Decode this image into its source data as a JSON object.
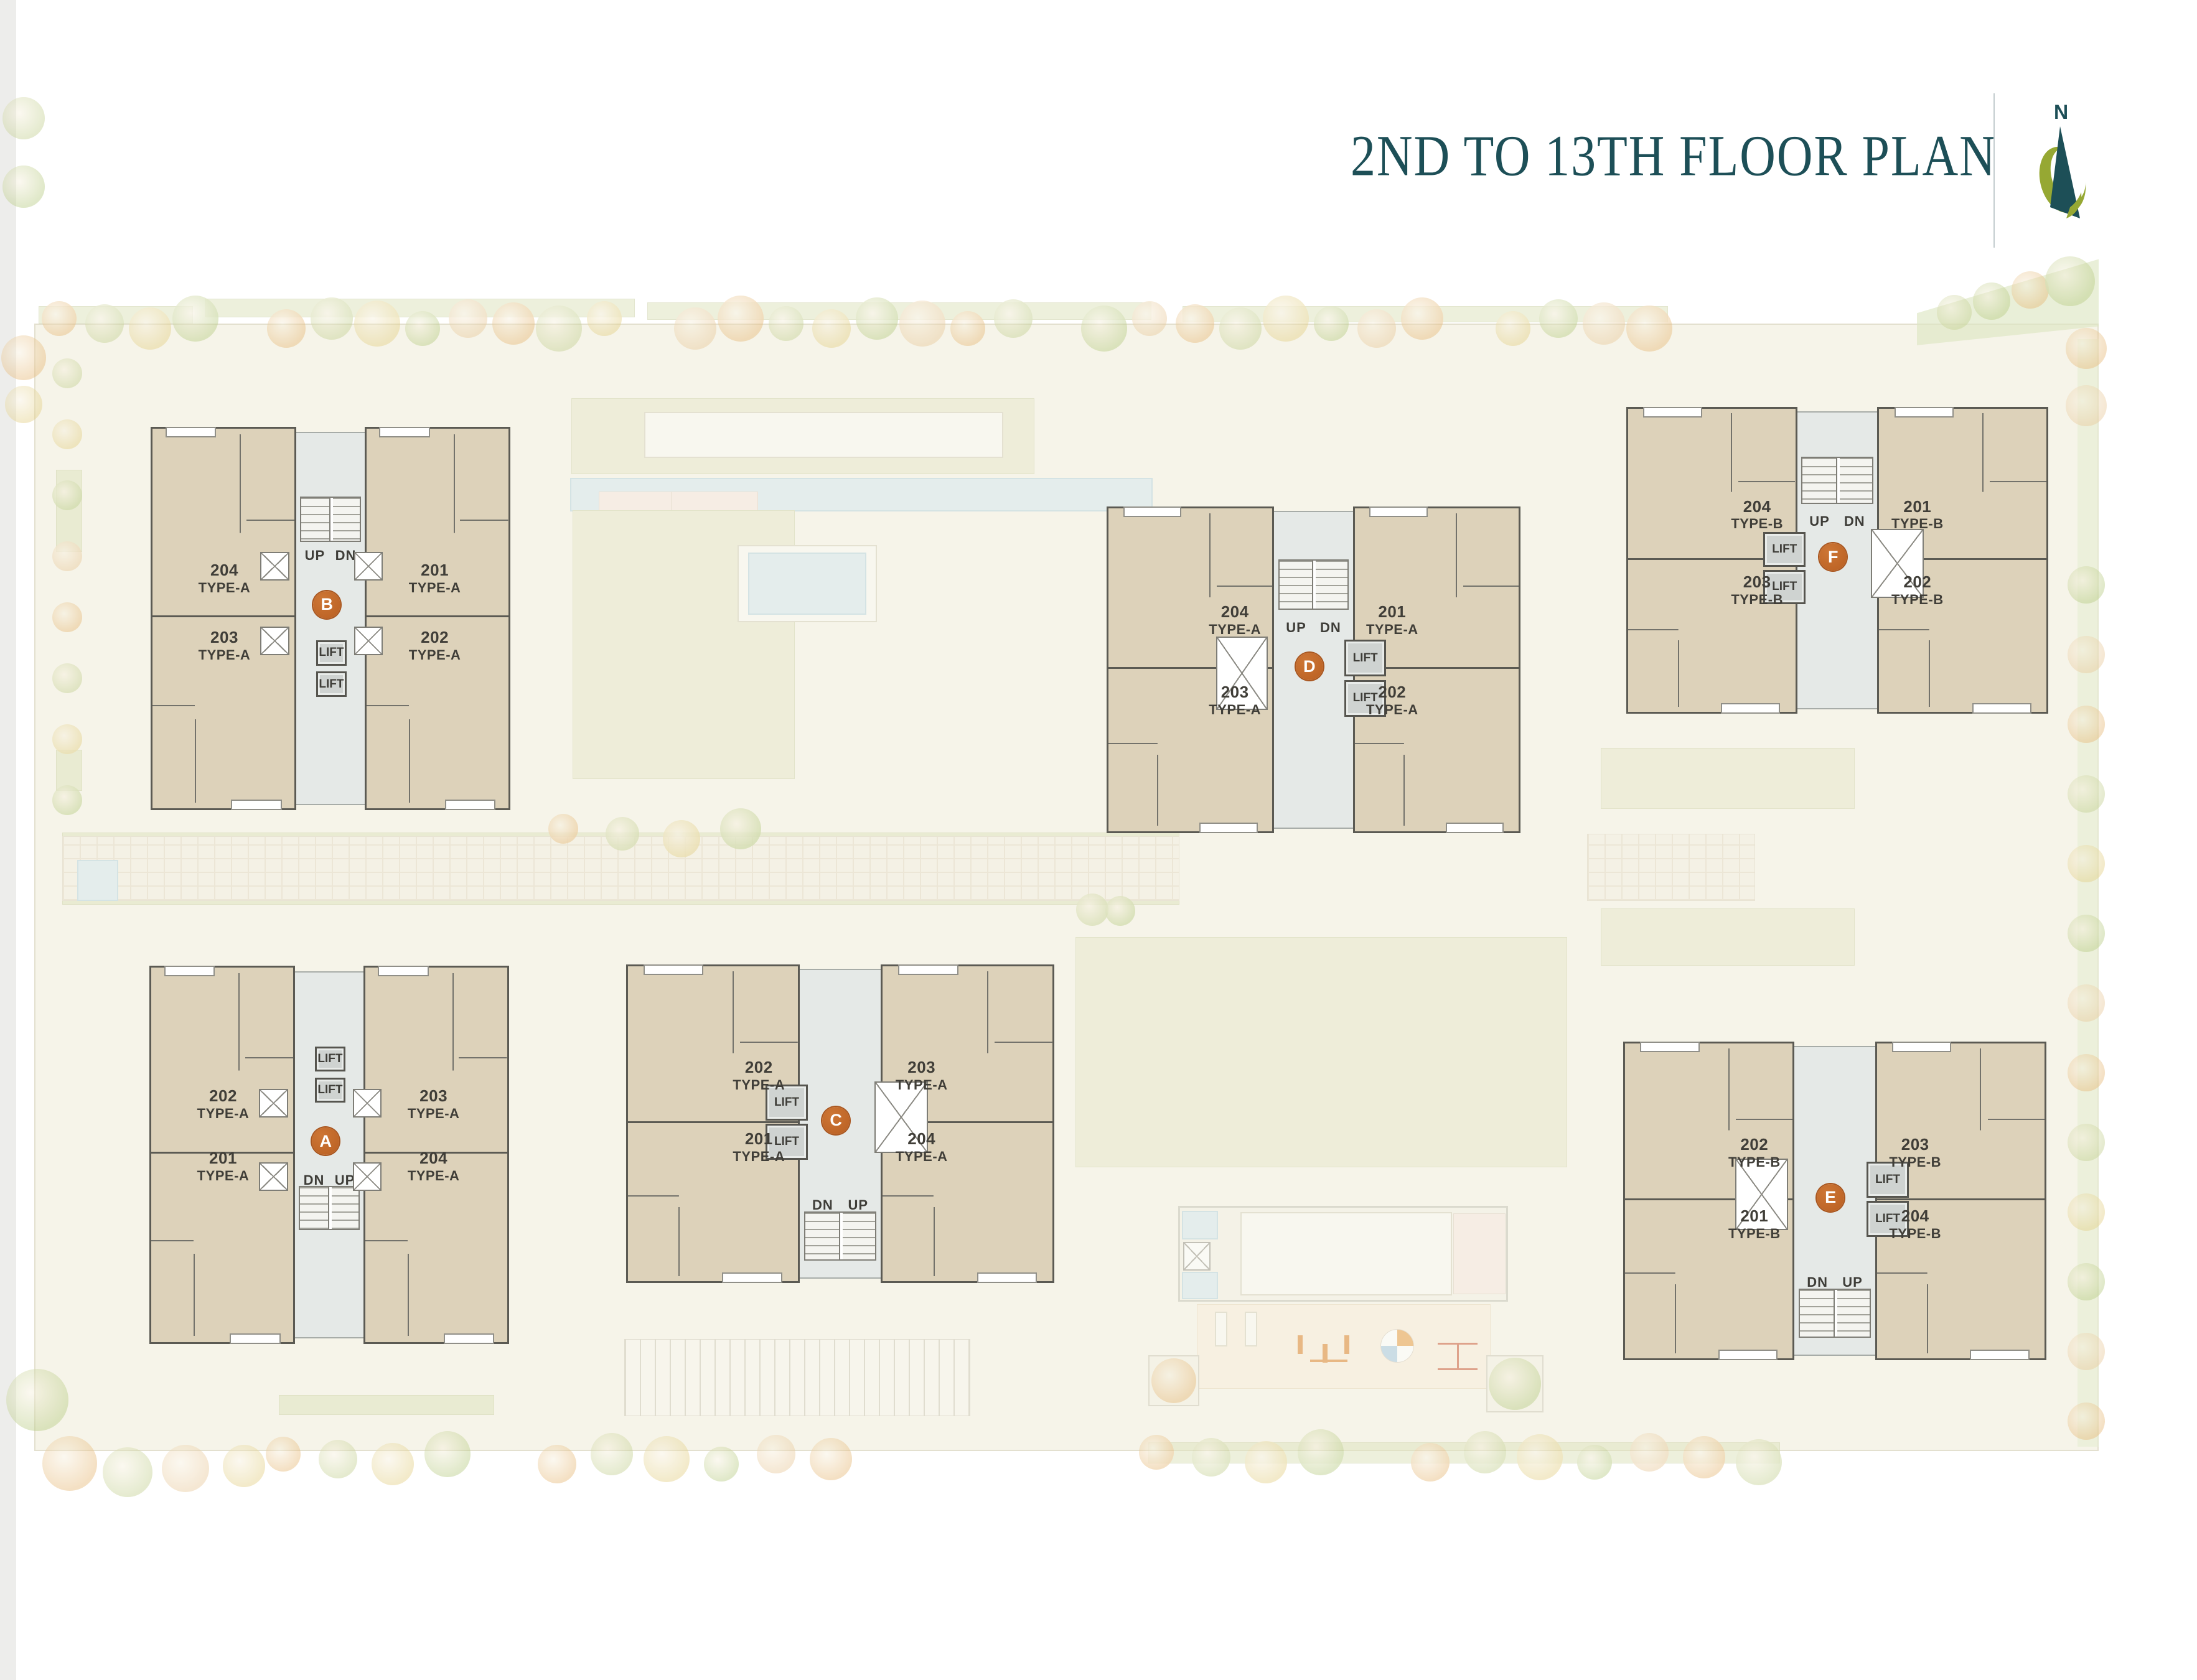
{
  "header": {
    "title": "2ND TO 13TH FLOOR PLAN",
    "compass_label": "N"
  },
  "colors": {
    "title_teal": "#1d4f57",
    "badge_orange": "#bf6327",
    "unit_fill": "#ddd2ba",
    "wall_gray": "#5b5a53",
    "core_gray": "#e5e9e7",
    "site_cream": "#f6f4e9",
    "lawn_green": "#e8e9cc",
    "water_blue": "#d6e8ef",
    "compass_olive": "#96a833"
  },
  "buildings": [
    {
      "letter": "B",
      "stair_labels": [
        "UP",
        "DN"
      ],
      "lift_labels": [
        "LIFT",
        "LIFT"
      ],
      "units": [
        {
          "number": "204",
          "type": "TYPE-A"
        },
        {
          "number": "201",
          "type": "TYPE-A"
        },
        {
          "number": "203",
          "type": "TYPE-A"
        },
        {
          "number": "202",
          "type": "TYPE-A"
        }
      ]
    },
    {
      "letter": "D",
      "stair_labels": [
        "UP",
        "DN"
      ],
      "lift_labels": [
        "LIFT",
        "LIFT"
      ],
      "units": [
        {
          "number": "204",
          "type": "TYPE-A"
        },
        {
          "number": "201",
          "type": "TYPE-A"
        },
        {
          "number": "203",
          "type": "TYPE-A"
        },
        {
          "number": "202",
          "type": "TYPE-A"
        }
      ]
    },
    {
      "letter": "F",
      "stair_labels": [
        "UP",
        "DN"
      ],
      "lift_labels": [
        "LIFT",
        "LIFT"
      ],
      "units": [
        {
          "number": "204",
          "type": "TYPE-B"
        },
        {
          "number": "201",
          "type": "TYPE-B"
        },
        {
          "number": "203",
          "type": "TYPE-B"
        },
        {
          "number": "202",
          "type": "TYPE-B"
        }
      ]
    },
    {
      "letter": "A",
      "stair_labels": [
        "DN",
        "UP"
      ],
      "lift_labels": [
        "LIFT",
        "LIFT"
      ],
      "units": [
        {
          "number": "202",
          "type": "TYPE-A"
        },
        {
          "number": "203",
          "type": "TYPE-A"
        },
        {
          "number": "201",
          "type": "TYPE-A"
        },
        {
          "number": "204",
          "type": "TYPE-A"
        }
      ]
    },
    {
      "letter": "C",
      "stair_labels": [
        "DN",
        "UP"
      ],
      "lift_labels": [
        "LIFT",
        "LIFT"
      ],
      "units": [
        {
          "number": "202",
          "type": "TYPE-A"
        },
        {
          "number": "203",
          "type": "TYPE-A"
        },
        {
          "number": "201",
          "type": "TYPE-A"
        },
        {
          "number": "204",
          "type": "TYPE-A"
        }
      ]
    },
    {
      "letter": "E",
      "stair_labels": [
        "DN",
        "UP"
      ],
      "lift_labels": [
        "LIFT",
        "LIFT"
      ],
      "units": [
        {
          "number": "202",
          "type": "TYPE-B"
        },
        {
          "number": "203",
          "type": "TYPE-B"
        },
        {
          "number": "201",
          "type": "TYPE-B"
        },
        {
          "number": "204",
          "type": "TYPE-B"
        }
      ]
    }
  ]
}
